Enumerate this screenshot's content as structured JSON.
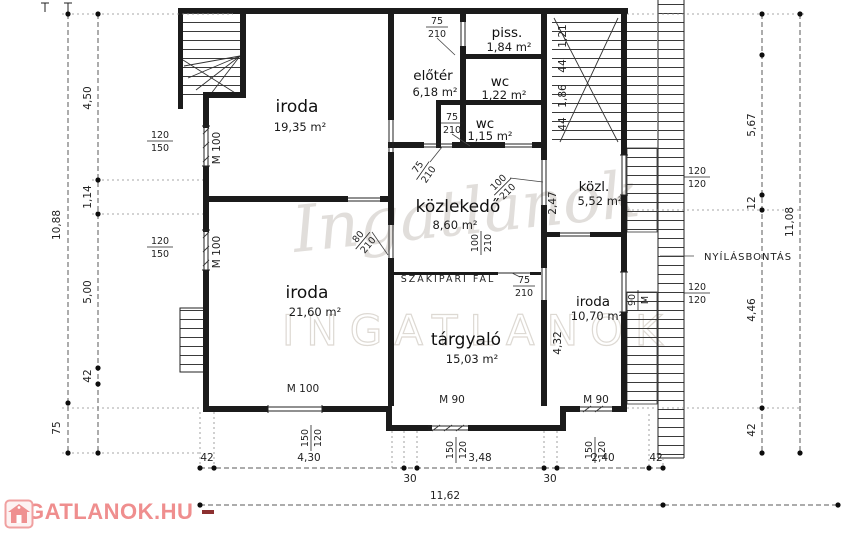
{
  "rooms": {
    "iroda_tl": {
      "name": "iroda",
      "area": "19,35 m²"
    },
    "eloter": {
      "name": "előtér",
      "area": "6,18 m²"
    },
    "piss": {
      "name": "piss.",
      "area": "1,84 m²"
    },
    "wc1": {
      "name": "wc",
      "area": "1,22 m²"
    },
    "wc2": {
      "name": "wc",
      "area": "1,15 m²"
    },
    "kozlekedo": {
      "name": "közlekedő",
      "area": "8,60 m²"
    },
    "kozl": {
      "name": "közl.",
      "area": "5,52 m²"
    },
    "iroda_bl": {
      "name": "iroda",
      "area": "21,60 m²"
    },
    "targyalo": {
      "name": "tárgyaló",
      "area": "15,03 m²"
    },
    "iroda_br": {
      "name": "iroda",
      "area": "10,70 m²"
    }
  },
  "annotations": {
    "partition": "SZAKIPARI FAL",
    "demolition": "NYÍLÁSBONTÁS"
  },
  "dims": {
    "left_total": "10,88",
    "left_450": "4,50",
    "left_114": "1,14",
    "left_500": "5,00",
    "left_42": "42",
    "left_75": "75",
    "right_567": "5,67",
    "right_12": "12",
    "right_446": "4,46",
    "right_42": "42",
    "right_total": "11,08",
    "bottom_42l": "42",
    "bottom_430": "4,30",
    "bottom_30l": "30",
    "bottom_348": "3,48",
    "bottom_30r": "30",
    "bottom_240": "2,40",
    "bottom_42r": "42",
    "bottom_total": "11,62",
    "door_m90a": "M 90",
    "door_m90b": "M 90",
    "m100_bottom": "M 100",
    "m100_left1": "M 100",
    "m100_left2": "M 100",
    "mid_247": "2,47",
    "mid_432": "4,32",
    "stair_121": "1,21",
    "stair_44a": "44",
    "stair_186": "1,86",
    "stair_44b": "44"
  },
  "fractions": {
    "win_left1": {
      "top": "120",
      "bot": "150"
    },
    "win_left2": {
      "top": "120",
      "bot": "150"
    },
    "win_right1": {
      "top": "120",
      "bot": "120"
    },
    "win_right2": {
      "top": "120",
      "bot": "120"
    },
    "win_bottom1": {
      "top": "150",
      "bot": "120"
    },
    "win_bottom2": {
      "top": "150",
      "bot": "120"
    },
    "win_bottom3": {
      "top": "150",
      "bot": "120"
    },
    "win_right_m90": {
      "top": "90",
      "bot": "M"
    },
    "door_75a": {
      "top": "75",
      "bot": "210"
    },
    "door_75b": {
      "top": "75",
      "bot": "210"
    },
    "door_75c": {
      "top": "75",
      "bot": "210"
    },
    "door_75d": {
      "top": "75",
      "bot": "210"
    },
    "door_80": {
      "top": "80",
      "bot": "210"
    },
    "door_100a": {
      "top": "100",
      "bot": "210"
    },
    "door_100b": {
      "top": "100",
      "bot": "210"
    }
  },
  "watermark": {
    "script": "Ingatlanok",
    "caps": "INGATLANOK"
  },
  "logo": {
    "text": "INGATLANOK.HU",
    "color": "#ef8e8e"
  }
}
